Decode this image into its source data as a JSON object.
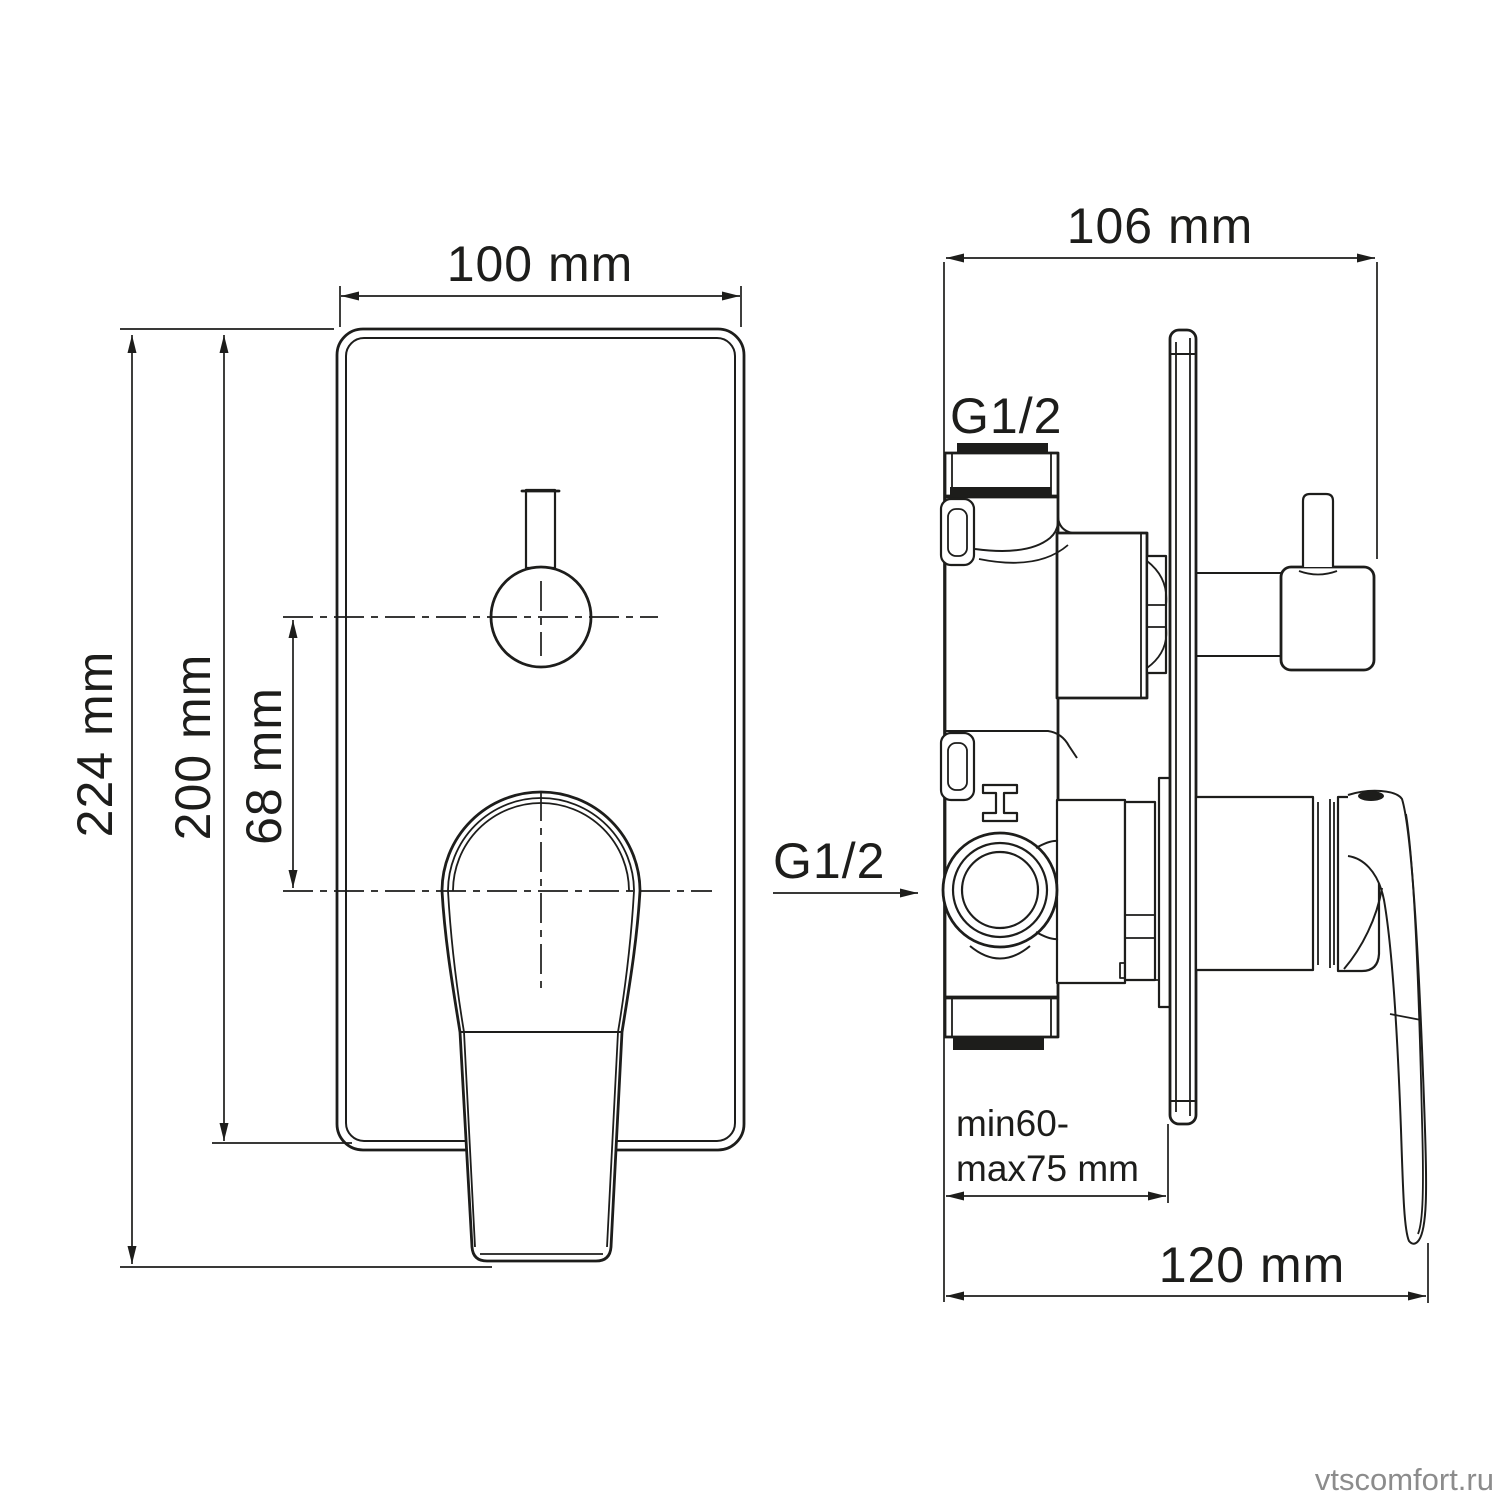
{
  "colors": {
    "line": "#1d1d1b",
    "background": "#ffffff",
    "watermark": "#8c8c8c"
  },
  "front_view": {
    "plate_width": "100 mm",
    "total_height": "224 mm",
    "plate_height": "200 mm",
    "knob_to_handle_offset": "68 mm"
  },
  "side_view": {
    "depth_to_knob": "106 mm",
    "top_port_thread": "G1/2",
    "side_port_thread": "G1/2",
    "wall_depth_line1": "min60-",
    "wall_depth_line2": "max75 mm",
    "overall_depth": "120 mm"
  },
  "watermark": "vtscomfort.ru"
}
